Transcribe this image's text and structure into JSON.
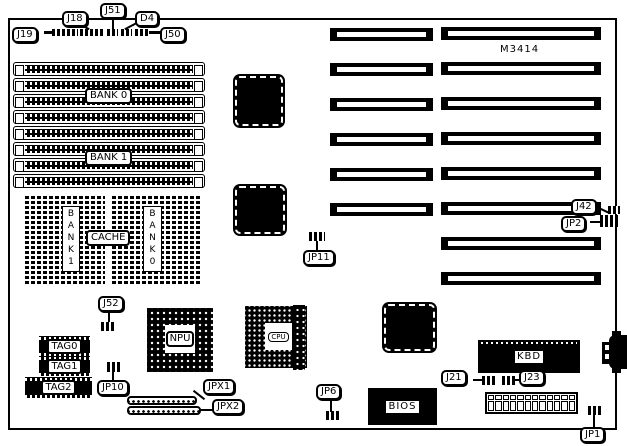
{
  "board_model": "M3414",
  "labels": {
    "j19": "J19",
    "j18": "J18",
    "j51": "J51",
    "d4": "D4",
    "j50": "J50",
    "bank0": "BANK 0",
    "bank1": "BANK 1",
    "cache": "CACHE",
    "cache_bank1": "BANK1",
    "cache_bank0": "BANK0",
    "j42": "J42",
    "jp2": "JP2",
    "jp11": "JP11",
    "j52": "J52",
    "jp10": "JP10",
    "tag0": "TAG0",
    "tag1": "TAG1",
    "tag2": "TAG2",
    "npu": "NPU",
    "cpu": "CPU",
    "jpx1": "JPX1",
    "jpx2": "JPX2",
    "jp6": "JP6",
    "bios": "BIOS",
    "j21": "J21",
    "j23": "J23",
    "kbd": "KBD",
    "jp1": "JP1"
  },
  "counts": {
    "simm_slots": 8,
    "expansion_slots_left": 6,
    "expansion_slots_right": 8,
    "power_pins": 12
  }
}
